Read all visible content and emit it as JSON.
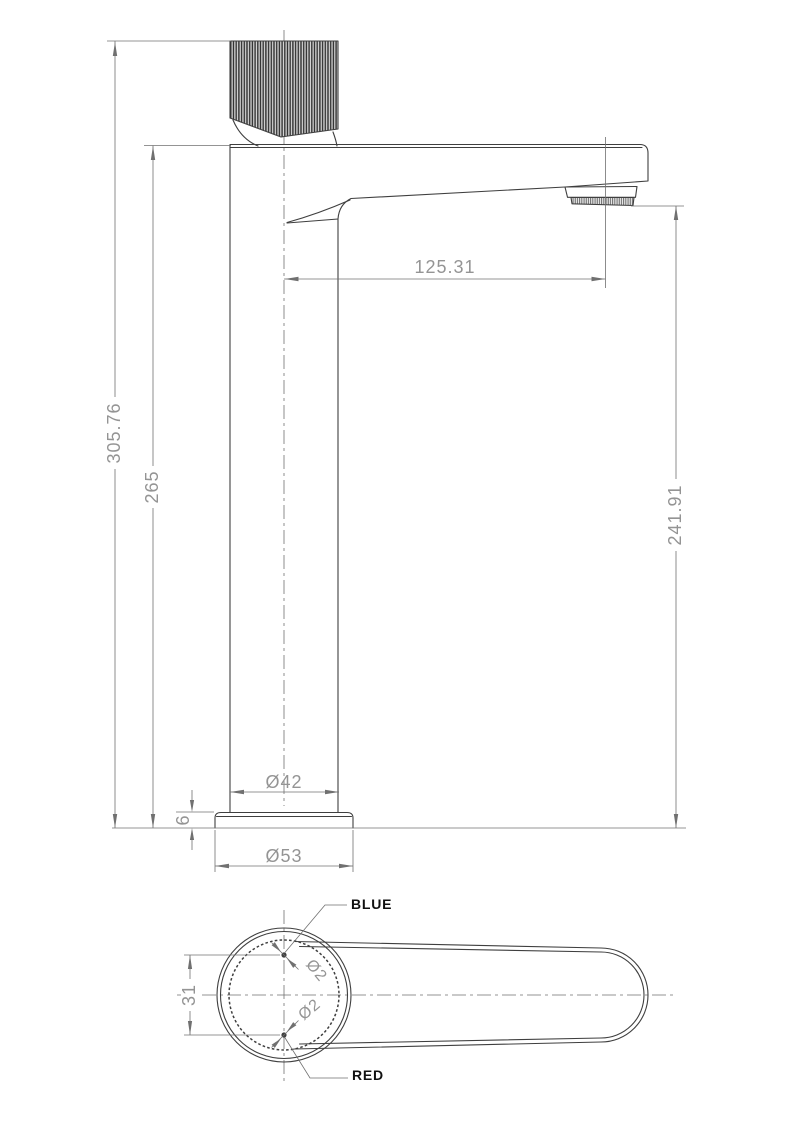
{
  "colors": {
    "background": "#ffffff",
    "line": "#3f3f3f",
    "dim_line": "#707070",
    "dim_text": "#949494",
    "label_text": "#111111",
    "knurl_dark": "#2f2f2f",
    "knurl_light": "#d8d8d8",
    "mesh_dark": "#555555"
  },
  "front_view": {
    "dims": {
      "total_height": "305.76",
      "spout_top_height": "265",
      "outlet_height": "241.91",
      "spout_reach": "125.31",
      "body_diameter": "Ø42",
      "base_diameter": "Ø53",
      "base_thickness": "6"
    }
  },
  "top_view": {
    "dims": {
      "hole_spacing": "31",
      "hole_top_diameter": "Ø2",
      "hole_bottom_diameter": "Ø2"
    },
    "labels": {
      "cold": "BLUE",
      "hot": "RED"
    }
  }
}
